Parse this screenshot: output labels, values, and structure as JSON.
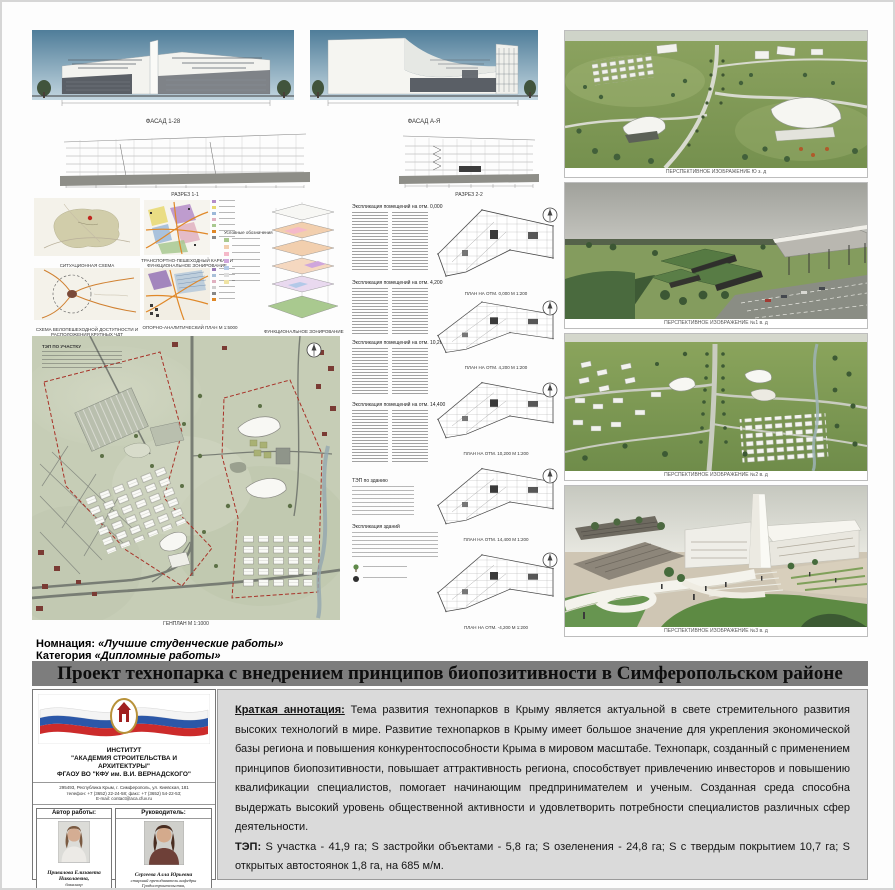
{
  "header": {
    "nomination_label": "Номнация:",
    "nomination_value": "«Лучшие студенческие работы»",
    "category_label": "Категория",
    "category_value": "«Дипломные работы»",
    "title": "Проект технопарка с внедрением принципов биопозитивности в Симферопольском районе"
  },
  "drawings": {
    "facade_labels": [
      "ФАСАД 1-28",
      "ФАСАД А-Я"
    ],
    "section_labels": [
      "РАЗРЕЗ 1-1",
      "РАЗРЕЗ 2-2"
    ]
  },
  "schemes": {
    "situational_caption": "СИТУАЦИОННАЯ СХЕМА",
    "accessibility_caption": "СХЕМА ВЕЛОПЕШЕХОДНОЙ ДОСТУПНОСТИ И РАСПОЛОЖЕНИЯ КРУПНЫХ ЧДТ",
    "transport_caption": "ТРАНСПОРТНО-ПЕШЕХОДНЫЙ КАРКАС И ФУНКЦИОНАЛЬНОЕ ЗОНИРОВАНИЕ",
    "analytical_caption": "ОПОРНО-АНАЛИТИЧЕСКИЙ ПЛАН М 1:5000",
    "functional_caption": "ФУНКЦИОНАЛЬНОЕ ЗОНИРОВАНИЕ",
    "legend_title": "Условные обозначения"
  },
  "masterplan": {
    "tep_title": "ТЭП ПО УЧАСТКУ",
    "caption": "ГЕНПЛАН М 1:1000"
  },
  "plans": {
    "table_titles": [
      "Экспликация помещений на отм. 0,000",
      "Экспликация помещений на отм. 4,200",
      "Экспликация помещений на отм. 10,200",
      "Экспликация помещений на отм. 14,400"
    ],
    "tep_building_title": "ТЭП по зданию",
    "explication_title": "Экспликация зданий",
    "plan_captions": [
      "ПЛАН НА ОТМ. 0,000 М 1:200",
      "ПЛАН НА ОТМ. 4,200 М 1:200",
      "ПЛАН НА ОТМ. 10,200 М 1:200",
      "ПЛАН НА ОТМ. 14,400 М 1:200",
      "ПЛАН НА ОТМ. -4,200 М 1:200"
    ]
  },
  "renders": {
    "captions": [
      "ПЕРСПЕКТИВНОЕ ИЗОБРАЖЕНИЕ Ю з. д",
      "ПЕРСПЕКТИВНОЕ ИЗОБРАЖЕНИЕ №1 в. д",
      "ПЕРСПЕКТИВНОЕ ИЗОБРАЖЕНИЕ №2 в. д",
      "ПЕРСПЕКТИВНОЕ ИЗОБРАЖЕНИЕ №3 в. д"
    ]
  },
  "institute": {
    "line1": "ИНСТИТУТ",
    "line2": "\"АКАДЕМИЯ СТРОИТЕЛЬСТВА И",
    "line3": "АРХИТЕКТУРЫ\"",
    "line4": "ФГАОУ ВО \"КФУ им. В.И. ВЕРНАДСКОГО\"",
    "address1": "295493, Республика Крым, г. Симферополь, ул. Киевская, 181",
    "address2": "телефон: +7 (3652) 22-24-58; факс: +7 (3652) 54-22-53;",
    "address3": "E-mail: contact@aca.cfuv.ru"
  },
  "people": {
    "author_label": "Автор работы:",
    "author_name": "Привалова Елизавета Николаевна,",
    "author_degree": "бакалавр",
    "author_email": "emilie2000@mail.ru",
    "supervisor_label": "Руководитель:",
    "supervisor_name": "Сергеева Алла Юрьевна",
    "supervisor_role": "старший преподаватель кафедры Градостроительства,",
    "supervisor_email": "grado2000@mail.ru"
  },
  "annotation": {
    "label": "Краткая аннотация:",
    "body": "Тема развития технопарков в Крыму является актуальной в свете стремительного развития высоких технологий в мире. Развитие технопарков в Крыму имеет большое значение для укрепления экономической базы региона и повышения конкурентоспособности Крыма в мировом масштабе. Технопарк, созданный с применением принципов биопозитивности, повышает аттрактивность региона, способствует привлечению инвесторов и повышению квалификации специалистов, помогает начинающим предпринимателем и ученым.  Созданная среда способна выдержать высокий уровень общественной активности и удовлетворить потребности специалистов различных сфер деятельности.",
    "tep_label": "ТЭП:",
    "tep_body": "S участка - 41,9 га; S застройки объектами - 5,8 га; S озеленения - 24,8 га; S с твердым покрытием 10,7 га; S открытых автостоянок 1,8 га, на 685 м/м."
  }
}
